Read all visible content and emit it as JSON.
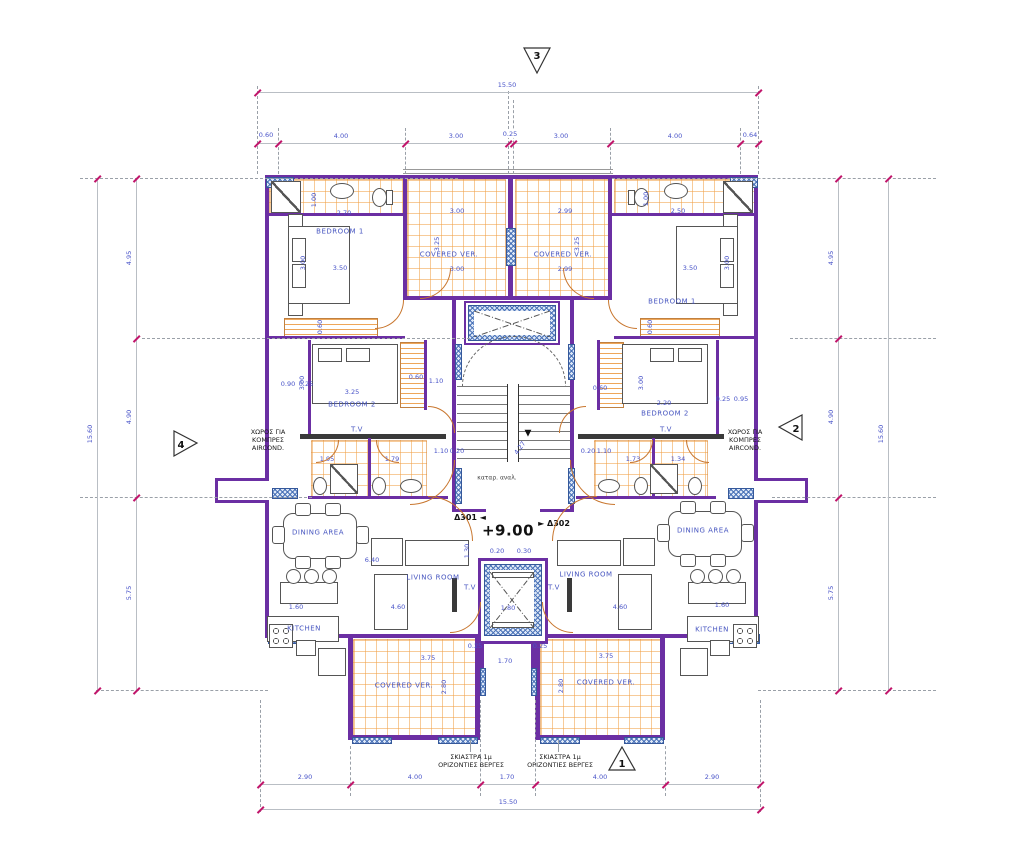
{
  "drawing": {
    "title_hint": "apartment floor plan level +9.00",
    "level_label": "+9.00",
    "colors": {
      "wall": "#6b2fa3",
      "tile": "#eda45c",
      "hatch": "#4a73b8",
      "dim_text": "#4853c8",
      "tick": "#c1156b",
      "door": "#c8762e"
    },
    "markers": [
      {
        "id": "1"
      },
      {
        "id": "2"
      },
      {
        "id": "3"
      },
      {
        "id": "4"
      }
    ],
    "dim_chains": [
      {
        "n": "top-overall",
        "o": "h",
        "a": 257,
        "b": 758,
        "p": 92,
        "ticks": [
          257,
          758
        ],
        "labels": [
          [
            "15.50",
            507
          ]
        ]
      },
      {
        "n": "top-segments",
        "o": "h",
        "a": 257,
        "b": 758,
        "p": 143,
        "ticks": [
          257,
          278,
          405,
          508,
          513,
          610,
          740,
          758
        ],
        "labels": [
          [
            "0.60",
            266,
            -8
          ],
          [
            "4.00",
            341
          ],
          [
            "3.00",
            456
          ],
          [
            "0.25",
            510,
            -9
          ],
          [
            "3.00",
            561
          ],
          [
            "4.00",
            675
          ],
          [
            "0.64",
            750,
            -8
          ]
        ]
      },
      {
        "n": "bottom-segments",
        "o": "h",
        "a": 260,
        "b": 760,
        "p": 784,
        "ticks": [
          260,
          350,
          480,
          535,
          665,
          760
        ],
        "labels": [
          [
            "2.90",
            305
          ],
          [
            "4.00",
            415
          ],
          [
            "1.70",
            507
          ],
          [
            "4.00",
            600
          ],
          [
            "2.90",
            712
          ]
        ]
      },
      {
        "n": "bottom-overall",
        "o": "h",
        "a": 260,
        "b": 760,
        "p": 809,
        "ticks": [
          260,
          760
        ],
        "labels": [
          [
            "15.50",
            508
          ]
        ]
      },
      {
        "n": "left-overall",
        "o": "v",
        "a": 178,
        "b": 690,
        "p": 97,
        "ticks": [
          178,
          690
        ],
        "labels": [
          [
            "15.60",
            434
          ]
        ]
      },
      {
        "n": "left-segments",
        "o": "v",
        "a": 178,
        "b": 690,
        "p": 136,
        "ticks": [
          178,
          338,
          497,
          690
        ],
        "labels": [
          [
            "4.95",
            258
          ],
          [
            "4.90",
            417
          ],
          [
            "5.75",
            593
          ]
        ]
      },
      {
        "n": "right-segments",
        "o": "v",
        "a": 178,
        "b": 690,
        "p": 838,
        "ticks": [
          178,
          338,
          497,
          690
        ],
        "labels": [
          [
            "4.95",
            258
          ],
          [
            "4.90",
            417
          ],
          [
            "5.75",
            593
          ]
        ]
      },
      {
        "n": "right-overall",
        "o": "v",
        "a": 178,
        "b": 690,
        "p": 888,
        "ticks": [
          178,
          690
        ],
        "labels": [
          [
            "15.60",
            434
          ]
        ]
      }
    ],
    "guides": [
      {
        "o": "v",
        "p": 257,
        "a": 86,
        "b": 174
      },
      {
        "o": "v",
        "p": 278,
        "a": 128,
        "b": 174
      },
      {
        "o": "v",
        "p": 405,
        "a": 128,
        "b": 174
      },
      {
        "o": "v",
        "p": 508,
        "a": 86,
        "b": 174
      },
      {
        "o": "v",
        "p": 513,
        "a": 100,
        "b": 174
      },
      {
        "o": "v",
        "p": 610,
        "a": 128,
        "b": 174
      },
      {
        "o": "v",
        "p": 740,
        "a": 128,
        "b": 174
      },
      {
        "o": "v",
        "p": 758,
        "a": 86,
        "b": 174
      },
      {
        "o": "h",
        "p": 178,
        "a": 80,
        "b": 458
      },
      {
        "o": "h",
        "p": 178,
        "a": 612,
        "b": 936
      },
      {
        "o": "h",
        "p": 338,
        "a": 142,
        "b": 470
      },
      {
        "o": "h",
        "p": 338,
        "a": 790,
        "b": 936
      },
      {
        "o": "h",
        "p": 497,
        "a": 80,
        "b": 312
      },
      {
        "o": "h",
        "p": 497,
        "a": 772,
        "b": 936
      },
      {
        "o": "h",
        "p": 690,
        "a": 96,
        "b": 268
      },
      {
        "o": "h",
        "p": 690,
        "a": 758,
        "b": 936
      },
      {
        "o": "v",
        "p": 260,
        "a": 700,
        "b": 812
      },
      {
        "o": "v",
        "p": 350,
        "a": 746,
        "b": 796
      },
      {
        "o": "v",
        "p": 480,
        "a": 700,
        "b": 796
      },
      {
        "o": "v",
        "p": 535,
        "a": 700,
        "b": 796
      },
      {
        "o": "v",
        "p": 665,
        "a": 746,
        "b": 796
      },
      {
        "o": "v",
        "p": 760,
        "a": 700,
        "b": 812
      },
      {
        "o": "v",
        "p": 470,
        "a": 740,
        "b": 752,
        "s": 1
      },
      {
        "o": "v",
        "p": 558,
        "a": 740,
        "b": 752,
        "s": 1
      }
    ],
    "xboxes": [
      {
        "x": 474,
        "y": 311,
        "w": 76,
        "h": 26
      },
      {
        "x": 490,
        "y": 572,
        "w": 44,
        "h": 56
      }
    ],
    "arcs": [
      {
        "x": 420,
        "y": 268,
        "s": 30,
        "c": "br"
      },
      {
        "x": 563,
        "y": 268,
        "s": 30,
        "c": "bl"
      },
      {
        "x": 375,
        "y": 300,
        "s": 28,
        "c": "br"
      },
      {
        "x": 608,
        "y": 300,
        "s": 28,
        "c": "bl"
      },
      {
        "x": 428,
        "y": 406,
        "s": 26,
        "c": "tr"
      },
      {
        "x": 559,
        "y": 406,
        "s": 26,
        "c": "tl"
      },
      {
        "x": 316,
        "y": 440,
        "s": 22,
        "c": "br"
      },
      {
        "x": 376,
        "y": 440,
        "s": 22,
        "c": "bl"
      },
      {
        "x": 630,
        "y": 440,
        "s": 22,
        "c": "br"
      },
      {
        "x": 686,
        "y": 440,
        "s": 22,
        "c": "bl"
      },
      {
        "x": 410,
        "y": 460,
        "s": 44,
        "c": "br"
      },
      {
        "x": 570,
        "y": 460,
        "s": 44,
        "c": "bl"
      },
      {
        "x": 428,
        "y": 496,
        "s": 44,
        "c": "tr"
      },
      {
        "x": 552,
        "y": 496,
        "s": 44,
        "c": "tl"
      },
      {
        "x": 450,
        "y": 602,
        "s": 30,
        "c": "br"
      },
      {
        "x": 542,
        "y": 602,
        "s": 30,
        "c": "bl"
      }
    ],
    "labels": [
      {
        "t": "BEDROOM  1",
        "x": 340,
        "y": 232,
        "c": "room"
      },
      {
        "t": "BEDROOM  1",
        "x": 672,
        "y": 302,
        "c": "room"
      },
      {
        "t": "COVERED VER.",
        "x": 449,
        "y": 255,
        "c": "room"
      },
      {
        "t": "COVERED VER.",
        "x": 563,
        "y": 255,
        "c": "room"
      },
      {
        "t": "BEDROOM 2",
        "x": 352,
        "y": 405,
        "c": "room"
      },
      {
        "t": "BEDROOM 2",
        "x": 665,
        "y": 414,
        "c": "room"
      },
      {
        "t": "T.V",
        "x": 357,
        "y": 430,
        "c": "room"
      },
      {
        "t": "T.V",
        "x": 666,
        "y": 430,
        "c": "room"
      },
      {
        "t": "DINING AREA",
        "x": 318,
        "y": 533,
        "c": "room"
      },
      {
        "t": "DINING AREA",
        "x": 703,
        "y": 531,
        "c": "room"
      },
      {
        "t": "LIVING ROOM",
        "x": 433,
        "y": 578,
        "c": "room"
      },
      {
        "t": "LIVING ROOM",
        "x": 586,
        "y": 575,
        "c": "room"
      },
      {
        "t": "T.V",
        "x": 470,
        "y": 588,
        "c": "room"
      },
      {
        "t": "T.V",
        "x": 554,
        "y": 588,
        "c": "room"
      },
      {
        "t": "KITCHEN",
        "x": 304,
        "y": 629,
        "c": "room"
      },
      {
        "t": "KITCHEN",
        "x": 712,
        "y": 630,
        "c": "room"
      },
      {
        "t": "COVERED VER.",
        "x": 404,
        "y": 686,
        "c": "room"
      },
      {
        "t": "COVERED VER.",
        "x": 606,
        "y": 683,
        "c": "room"
      },
      {
        "t": "ΧΩΡΟΣ ΓΙΑ\nΚΟΜΠΡΕΣ\nAIRCOND.",
        "x": 268,
        "y": 440,
        "c": "note"
      },
      {
        "t": "ΧΩΡΟΣ ΓΙΑ\nΚΟΜΠΡΕΣ\nAIRCOND.",
        "x": 745,
        "y": 440,
        "c": "note"
      },
      {
        "t": "ΣΚΙΑΣΤΡΑ 1μ\nΟΡΙΖΟΝΤΙΕΣ ΒΕΡΓΕΣ",
        "x": 471,
        "y": 761,
        "c": "note"
      },
      {
        "t": "ΣΚΙΑΣΤΡΑ 1μ\nΟΡΙΖΟΝΤΙΕΣ ΒΕΡΓΕΣ",
        "x": 560,
        "y": 761,
        "c": "note"
      },
      {
        "t": "καταρ. αναλ.",
        "x": 497,
        "y": 478,
        "c": "smnote"
      },
      {
        "t": "Δ301 ◄",
        "x": 470,
        "y": 518,
        "c": "unit"
      },
      {
        "t": "► Δ302",
        "x": 554,
        "y": 524,
        "c": "unit"
      },
      {
        "t": "+9.00",
        "x": 508,
        "y": 531,
        "c": "big"
      },
      {
        "t": "▼",
        "x": 528,
        "y": 434,
        "c": "blk"
      },
      {
        "t": "2.70",
        "x": 344,
        "y": 213
      },
      {
        "t": "1.00",
        "x": 314,
        "y": 200,
        "r": -90
      },
      {
        "t": "1.00",
        "x": 646,
        "y": 199,
        "r": -90
      },
      {
        "t": "2.50",
        "x": 678,
        "y": 211
      },
      {
        "t": "3.00",
        "x": 457,
        "y": 211
      },
      {
        "t": "2.99",
        "x": 565,
        "y": 211
      },
      {
        "t": "3.00",
        "x": 457,
        "y": 269
      },
      {
        "t": "2.99",
        "x": 565,
        "y": 269
      },
      {
        "t": "3.25",
        "x": 437,
        "y": 244,
        "r": -90
      },
      {
        "t": "3.25",
        "x": 577,
        "y": 244,
        "r": -90
      },
      {
        "t": "3.00",
        "x": 303,
        "y": 263,
        "r": -90
      },
      {
        "t": "3.50",
        "x": 340,
        "y": 268
      },
      {
        "t": "3.50",
        "x": 690,
        "y": 268
      },
      {
        "t": "3.00",
        "x": 727,
        "y": 263,
        "r": -90
      },
      {
        "t": "0.60",
        "x": 320,
        "y": 327,
        "r": -90
      },
      {
        "t": "0.60",
        "x": 650,
        "y": 327,
        "r": -90
      },
      {
        "t": "0.90",
        "x": 288,
        "y": 384
      },
      {
        "t": "0.25",
        "x": 306,
        "y": 384
      },
      {
        "t": "3.00",
        "x": 302,
        "y": 383,
        "r": -90
      },
      {
        "t": "3.25",
        "x": 352,
        "y": 392
      },
      {
        "t": "0.60",
        "x": 416,
        "y": 377
      },
      {
        "t": "1.10",
        "x": 436,
        "y": 381
      },
      {
        "t": "0.60",
        "x": 600,
        "y": 388
      },
      {
        "t": "2.20",
        "x": 664,
        "y": 403
      },
      {
        "t": "3.00",
        "x": 641,
        "y": 383,
        "r": -90
      },
      {
        "t": "0.25",
        "x": 723,
        "y": 399
      },
      {
        "t": "0.95",
        "x": 741,
        "y": 399
      },
      {
        "t": "1.95",
        "x": 327,
        "y": 459
      },
      {
        "t": "1.79",
        "x": 392,
        "y": 459
      },
      {
        "t": "1.73",
        "x": 633,
        "y": 459
      },
      {
        "t": "1.34",
        "x": 678,
        "y": 459
      },
      {
        "t": "1.10",
        "x": 441,
        "y": 451
      },
      {
        "t": "0.20",
        "x": 457,
        "y": 451
      },
      {
        "t": "1.10",
        "x": 604,
        "y": 451
      },
      {
        "t": "0.20",
        "x": 588,
        "y": 451
      },
      {
        "t": "4.27",
        "x": 520,
        "y": 448,
        "r": -55
      },
      {
        "t": "0.20",
        "x": 497,
        "y": 551
      },
      {
        "t": "0.30",
        "x": 524,
        "y": 551
      },
      {
        "t": "1.30",
        "x": 467,
        "y": 551,
        "r": -90
      },
      {
        "t": "6.40",
        "x": 372,
        "y": 560
      },
      {
        "t": "4.60",
        "x": 398,
        "y": 607
      },
      {
        "t": "4.60",
        "x": 620,
        "y": 607
      },
      {
        "t": "1.60",
        "x": 296,
        "y": 607
      },
      {
        "t": "1.60",
        "x": 722,
        "y": 605
      },
      {
        "t": "1.80",
        "x": 508,
        "y": 608
      },
      {
        "t": "3.75",
        "x": 428,
        "y": 658
      },
      {
        "t": "3.75",
        "x": 606,
        "y": 656
      },
      {
        "t": "2.80",
        "x": 444,
        "y": 687,
        "r": -90
      },
      {
        "t": "2.80",
        "x": 561,
        "y": 686,
        "r": -90
      },
      {
        "t": "1.70",
        "x": 505,
        "y": 661
      },
      {
        "t": "0.25",
        "x": 475,
        "y": 646
      },
      {
        "t": "0.25",
        "x": 540,
        "y": 646
      }
    ]
  }
}
